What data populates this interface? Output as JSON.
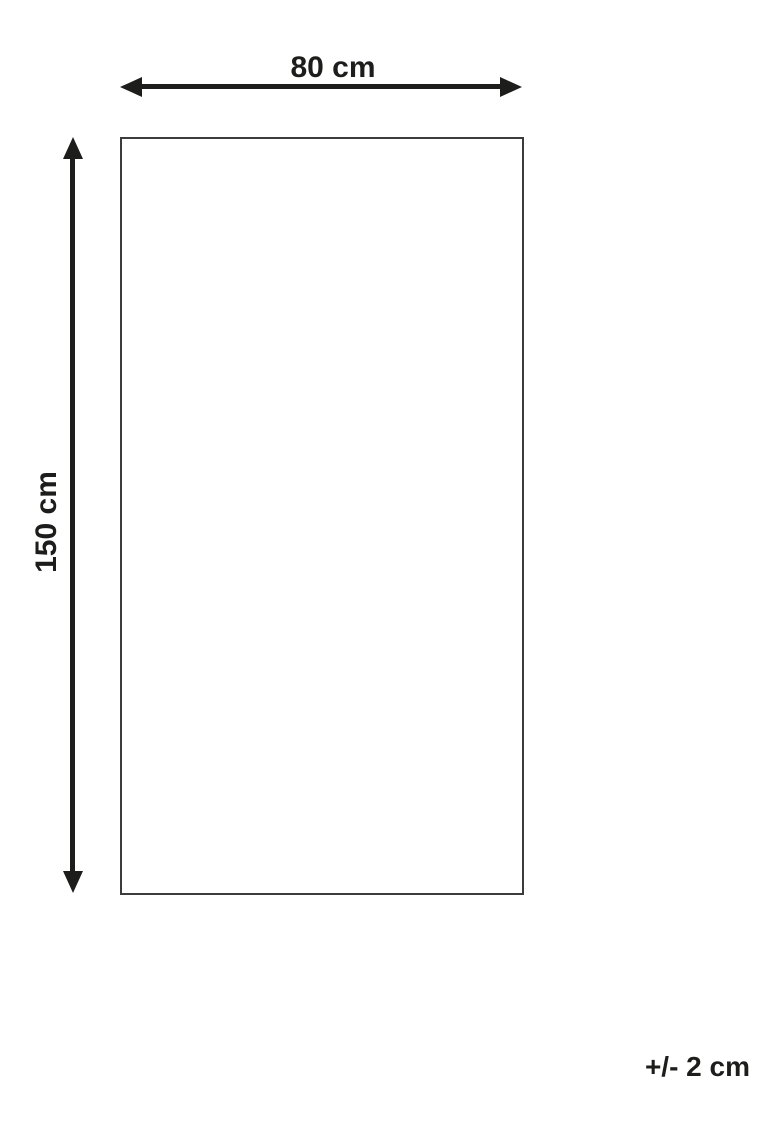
{
  "diagram": {
    "width_label": "80 cm",
    "height_label": "150 cm",
    "tolerance_label": "+/- 2 cm"
  },
  "colors": {
    "line": "#1d1d1b",
    "text": "#1d1d1b",
    "outline": "#3c3c3b",
    "background": "#ffffff"
  }
}
